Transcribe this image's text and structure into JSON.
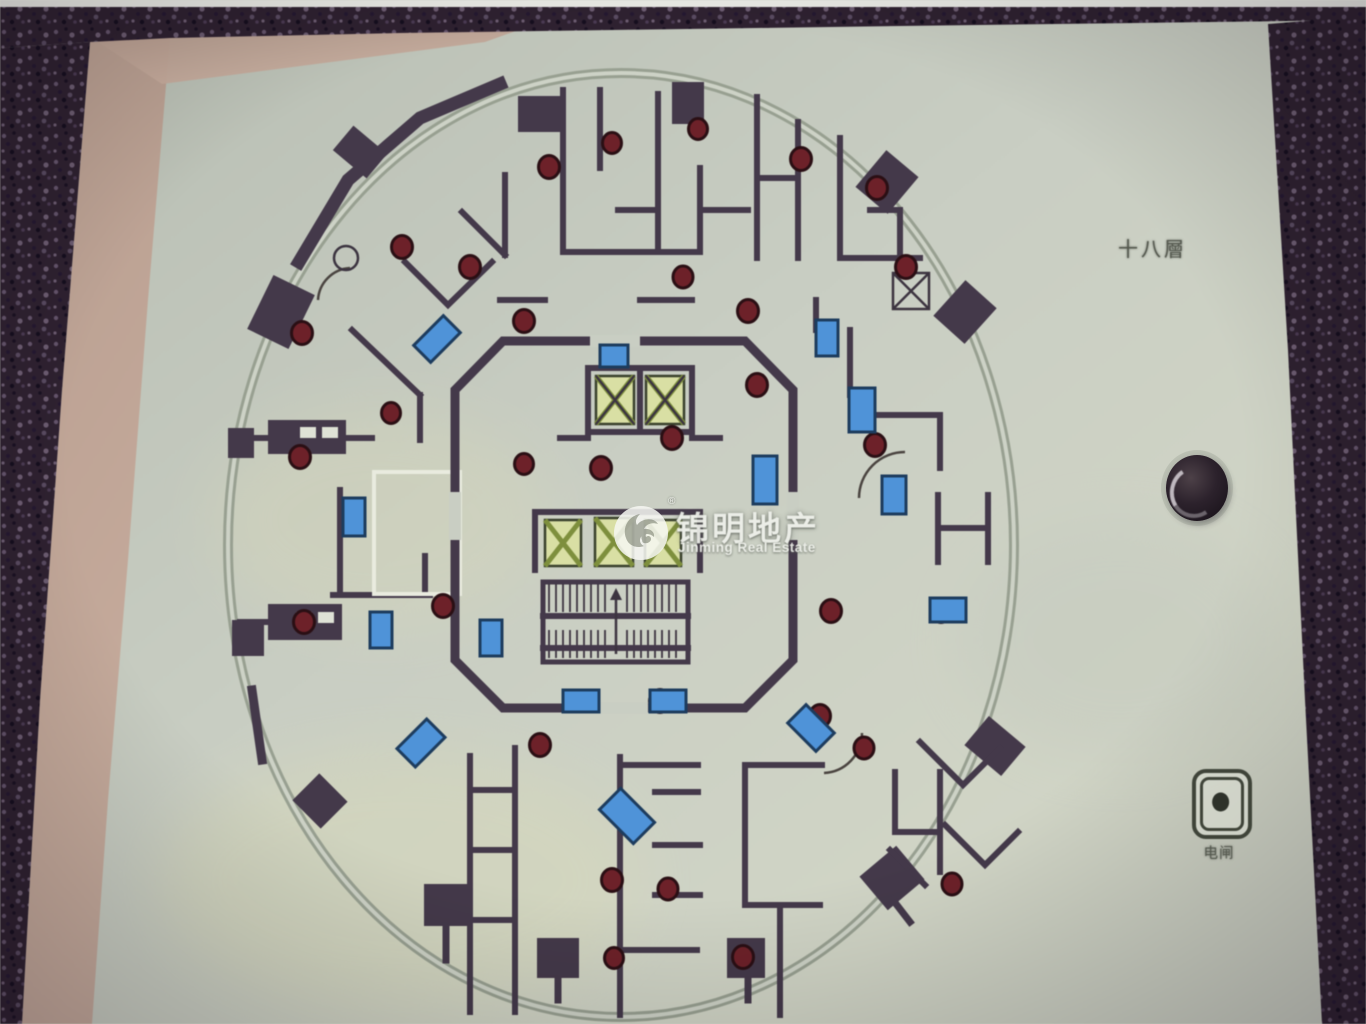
{
  "sign": {
    "floor_label": "十八層",
    "outlet_label": "电闸"
  },
  "watermark": {
    "brand_cn": "锦明地产",
    "brand_en": "Jinming Real Estate",
    "registered_mark": "®"
  },
  "icons": {
    "jinming_logo": "swirl-in-circle",
    "power_outlet": "dot-in-rounded-square",
    "panel_hole": "dark-circular-hole",
    "elevator": "square-with-x-cross",
    "stairs": "hatched-treads",
    "column": "dark-red-dot",
    "door": "blue-rectangle"
  },
  "colors": {
    "granite_dark": "#2e2130",
    "granite_speck": "#63536a",
    "frame_beige": "#b89e90",
    "frame_beige_light": "#c8ad9e",
    "panel_light": "#c9cec3",
    "wall_dark": "#44394a",
    "column_red": "#6d2129",
    "door_blue": "#4f93d8",
    "elevator_fill": "#d9dfa4",
    "elevator_cross": "#7e8f3d",
    "perimeter_gray": "#98a091",
    "label_gray": "#54584e"
  }
}
